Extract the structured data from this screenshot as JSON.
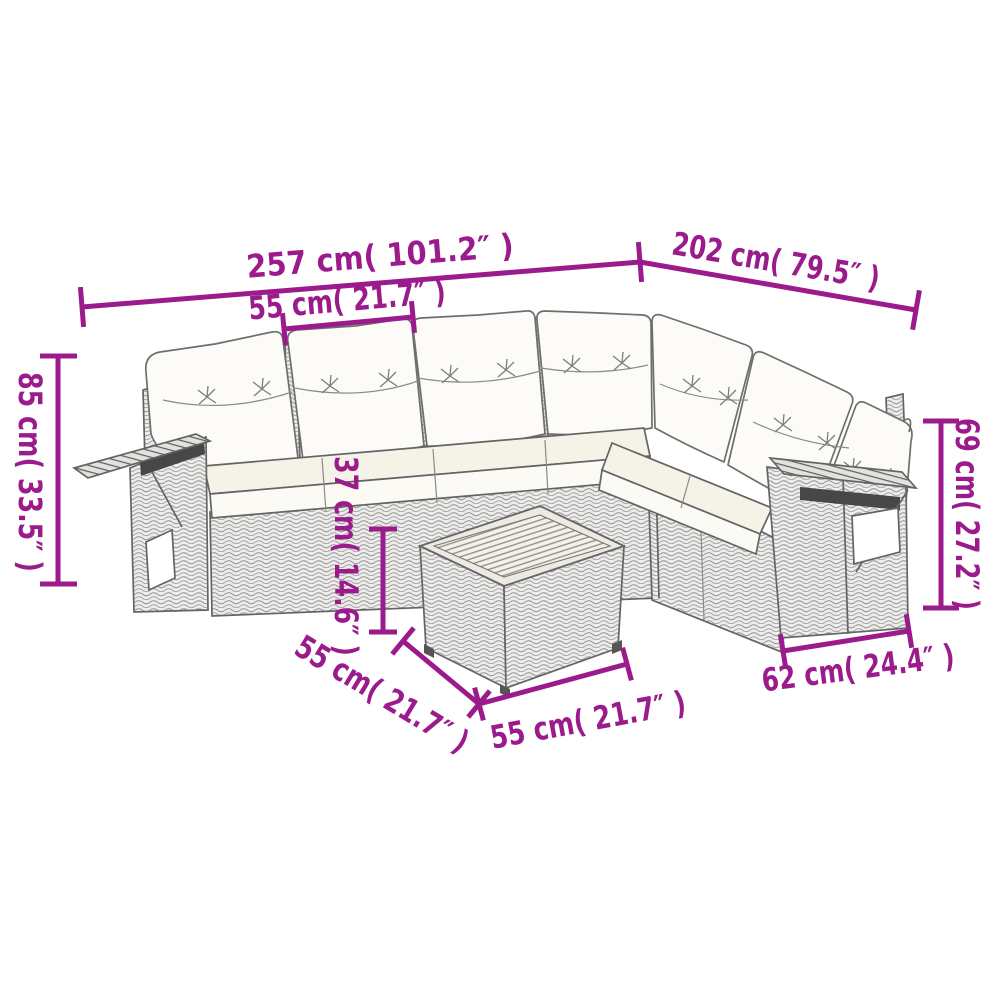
{
  "figure": {
    "title": "Garden lounge set dimension diagram",
    "background": "#ffffff"
  },
  "colors": {
    "accent": "#9b1b8c",
    "line": "#646464",
    "wicker_line": "#a0a0a0",
    "cushion": "#fcfbf7",
    "seat_cushion": "#f5f2e8",
    "wood_top": "#f3f1ea"
  },
  "dims": {
    "total_width_left": {
      "cm": 257,
      "in": 101.2,
      "label": "257 cm( 101.2″ )"
    },
    "total_width_right": {
      "cm": 202,
      "in": 79.5,
      "label": "202 cm( 79.5″ )"
    },
    "seat_width": {
      "cm": 55,
      "in": 21.7,
      "label": "55 cm( 21.7″ )"
    },
    "total_height": {
      "cm": 85,
      "in": 33.5,
      "label": "85 cm( 33.5″ )"
    },
    "arm_height": {
      "cm": 69,
      "in": 27.2,
      "label": "69 cm( 27.2″ )"
    },
    "table_height": {
      "cm": 37,
      "in": 14.6,
      "label": "37 cm( 14.6″ )"
    },
    "table_depth": {
      "cm": 55,
      "in": 21.7,
      "label": "55 cm( 21.7″ )"
    },
    "table_width": {
      "cm": 55,
      "in": 21.7,
      "label": "55 cm( 21.7″ )"
    },
    "seat_depth": {
      "cm": 62,
      "in": 24.4,
      "label": "62 cm( 24.4″ )"
    }
  }
}
